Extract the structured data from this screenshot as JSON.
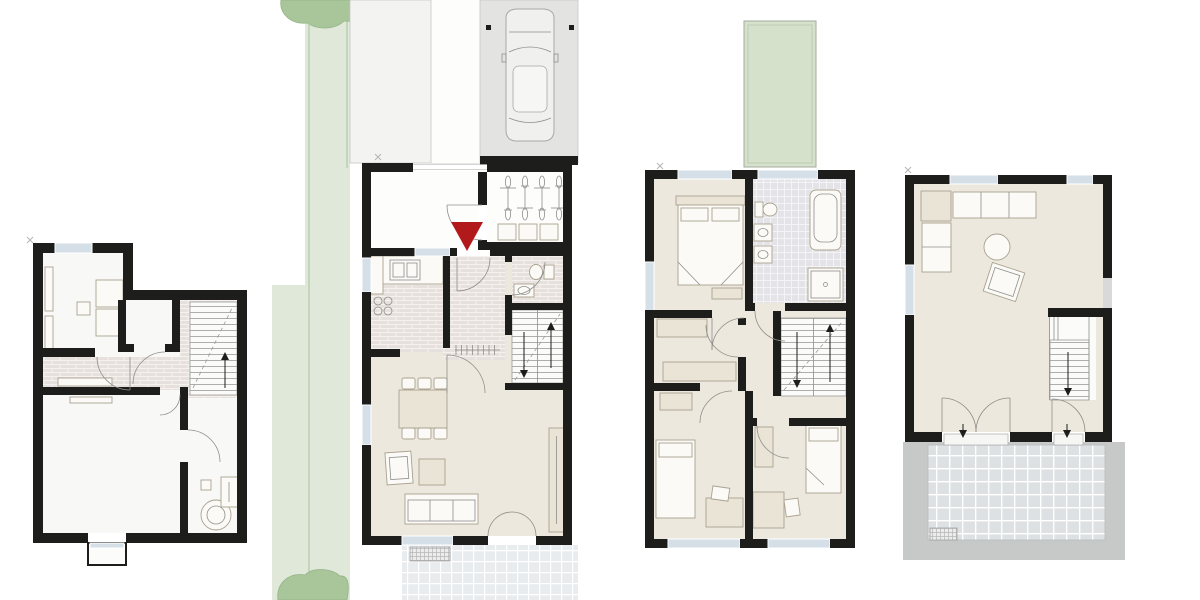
{
  "colors": {
    "wall": "#1d1d1b",
    "floorCream": "#ece8dd",
    "floorWhite": "#f8f8f7",
    "tileBrick": "#e7e1dd",
    "tileBrickLine": "#f6f1ee",
    "tileBath": "#e4e3e8",
    "tileBathLine": "#f4f4f6",
    "terrTile": "#e9ecef",
    "terr2Tile": "#dde1e4",
    "gravel": "#c7c9c9",
    "greenStrip": "#dfe8d9",
    "tree": "#a9c69b",
    "treeStroke": "#93b286",
    "pool": "#d5e1cb",
    "poolStroke": "#a2ad9c",
    "siteGray": "#f3f3f2",
    "parkGray": "#e3e3e2",
    "glass": "#d4dfe8",
    "furnWhite": "#fbfaf7",
    "furnCream": "#eae4d6",
    "furnStroke": "#aaa290",
    "lineGray": "#8e8e8a",
    "red": "#b1191b",
    "mark": "#b5b5b5"
  },
  "site": {
    "parking_cars": 1,
    "bicycles": 4,
    "waste_bins": 3,
    "trees": 2,
    "entrance_marker": "red-triangle"
  },
  "plans": [
    {
      "id": "basement",
      "elements": [
        "utility-room",
        "washer-dryer",
        "storage-room",
        "stairs",
        "hall-tiled",
        "hobby-room",
        "technical-room",
        "boiler",
        "light-well"
      ]
    },
    {
      "id": "ground-floor",
      "elements": [
        "entry-court",
        "entrance-marker",
        "bike-storage",
        "waste-bins",
        "kitchen",
        "wc",
        "stairs",
        "dining-table",
        "armchair",
        "sofa",
        "cabinet",
        "terrace",
        "garden-strip",
        "parking-space"
      ]
    },
    {
      "id": "upper-floor",
      "elements": [
        "master-bedroom",
        "double-bed",
        "bathroom",
        "bathtub",
        "shower",
        "sinks",
        "wc",
        "dressing-room",
        "stairs",
        "kids-room-left",
        "kids-room-right",
        "desks",
        "green-roof"
      ]
    },
    {
      "id": "studio-floor",
      "elements": [
        "living-room",
        "corner-sofa",
        "round-pouf",
        "tilted-table",
        "stairs",
        "terrace",
        "gravel-border",
        "doormat"
      ]
    }
  ],
  "counts": {
    "dining_chairs": 6,
    "stair_flights": 6
  }
}
